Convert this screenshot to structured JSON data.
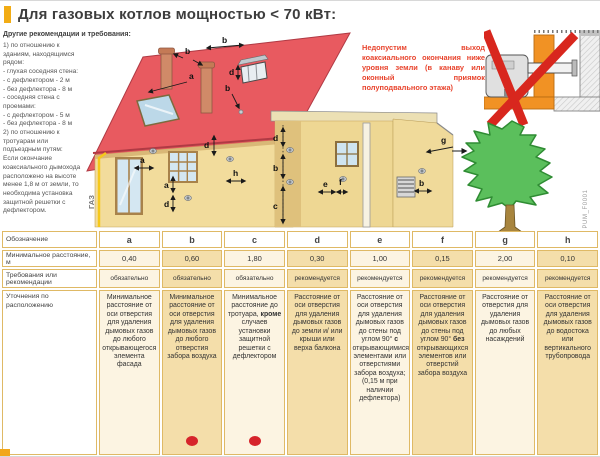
{
  "title": {
    "text": "Для газовых котлов мощностью < 70 кВт:"
  },
  "sidebar": {
    "heading": "Другие рекомендации и требования:",
    "body": "1) по отношению к зданиям, находящимся рядом:\n- глухая соседняя стена:\n- с дефлектором - 2 м\n- без дефлектора - 8 м\n- соседняя стена с проемами:\n- с дефлектором - 5 м\n- без дефлектора - 8 м\n2) по отношению к тротуарам или подъездным путям:\nЕсли окончание коаксиального дымохода расположено на высоте менее 1,8 м от земли, то необходима установка защитной решетки с дефлектором."
  },
  "warning": {
    "text": "Недопустим выход коаксиального окончания ниже уровня земли (в канаву или оконный приямок полуподвального этажа)"
  },
  "diagram": {
    "gas_label": "ГАЗ",
    "labels": {
      "b1": "b",
      "b2": "b",
      "a1": "a",
      "b3": "b",
      "d1": "d",
      "a2": "a",
      "d2": "d",
      "h1": "h",
      "a3": "a",
      "d3": "d",
      "ext_d": "d",
      "ext_b": "b",
      "ext_c": "c",
      "ext_e": "e",
      "ext_f": "f",
      "ext_g": "g",
      "ext_b2": "b"
    }
  },
  "watermark": "PUM_F0001",
  "colors": {
    "accent_marker": "#f2ac14",
    "warning_red": "#e8432c",
    "roof_red": "#e85a60",
    "wall_yellow": "#f2dc9c",
    "tree_green": "#5bbf5c",
    "table_border_gold": "#dfb965",
    "dot_red": "#d6242b",
    "cross_red": "#d8271e"
  },
  "table": {
    "row_labels": {
      "designation": "Обозначение",
      "min_distance": "Минимальное расстояние, м",
      "requirement": "Требования или рекомендации",
      "notes": "Уточнения по расположению"
    },
    "columns": [
      {
        "letter": "a",
        "distance": "0,40",
        "requirement": "обязательно",
        "dot": false,
        "note": "Минимальное расстояние от оси отверстия для удаления дымовых газов до любого открывающегося элемента фасада"
      },
      {
        "letter": "b",
        "distance": "0,60",
        "requirement": "обязательно",
        "dot": true,
        "note": "Минимальное расстояние от оси отверстия для удаления дымовых газов до любого отверстия забора воздуха"
      },
      {
        "letter": "c",
        "distance": "1,80",
        "requirement": "обязательно",
        "dot": true,
        "note": "Минимальное расстояние до тротуара, <b>кроме</b> случаев установки защитной решетки с дефлектором"
      },
      {
        "letter": "d",
        "distance": "0,30",
        "requirement": "рекомендуется",
        "dot": false,
        "note": "Расстояние от оси отверстия для удаления дымовых газов до земли и/ или крыши или верха балкона"
      },
      {
        "letter": "e",
        "distance": "1,00",
        "requirement": "рекомендуется",
        "dot": false,
        "note": "Расстояние от оси отверстия для удаления дымовых газов до стены под углом 90° <b>с</b> открывающимися элементами или отверстиями забора воздуха; (0,15 м при наличии дефлектора)"
      },
      {
        "letter": "f",
        "distance": "0,15",
        "requirement": "рекомендуется",
        "dot": false,
        "note": "Расстояние от оси отверстия для удаления дымовых газов до стены под углом 90° <b>без</b> открывающихся элементов или отверстий забора воздуха"
      },
      {
        "letter": "g",
        "distance": "2,00",
        "requirement": "рекомендуется",
        "dot": false,
        "note": "Расстояние от отверстия для удаления дымовых газов до любых насаждений"
      },
      {
        "letter": "h",
        "distance": "0,10",
        "requirement": "рекомендуется",
        "dot": false,
        "note": "Расстояние от оси отверстия для удаления дымовых газов до водостока или вертикального трубопровода"
      }
    ]
  }
}
